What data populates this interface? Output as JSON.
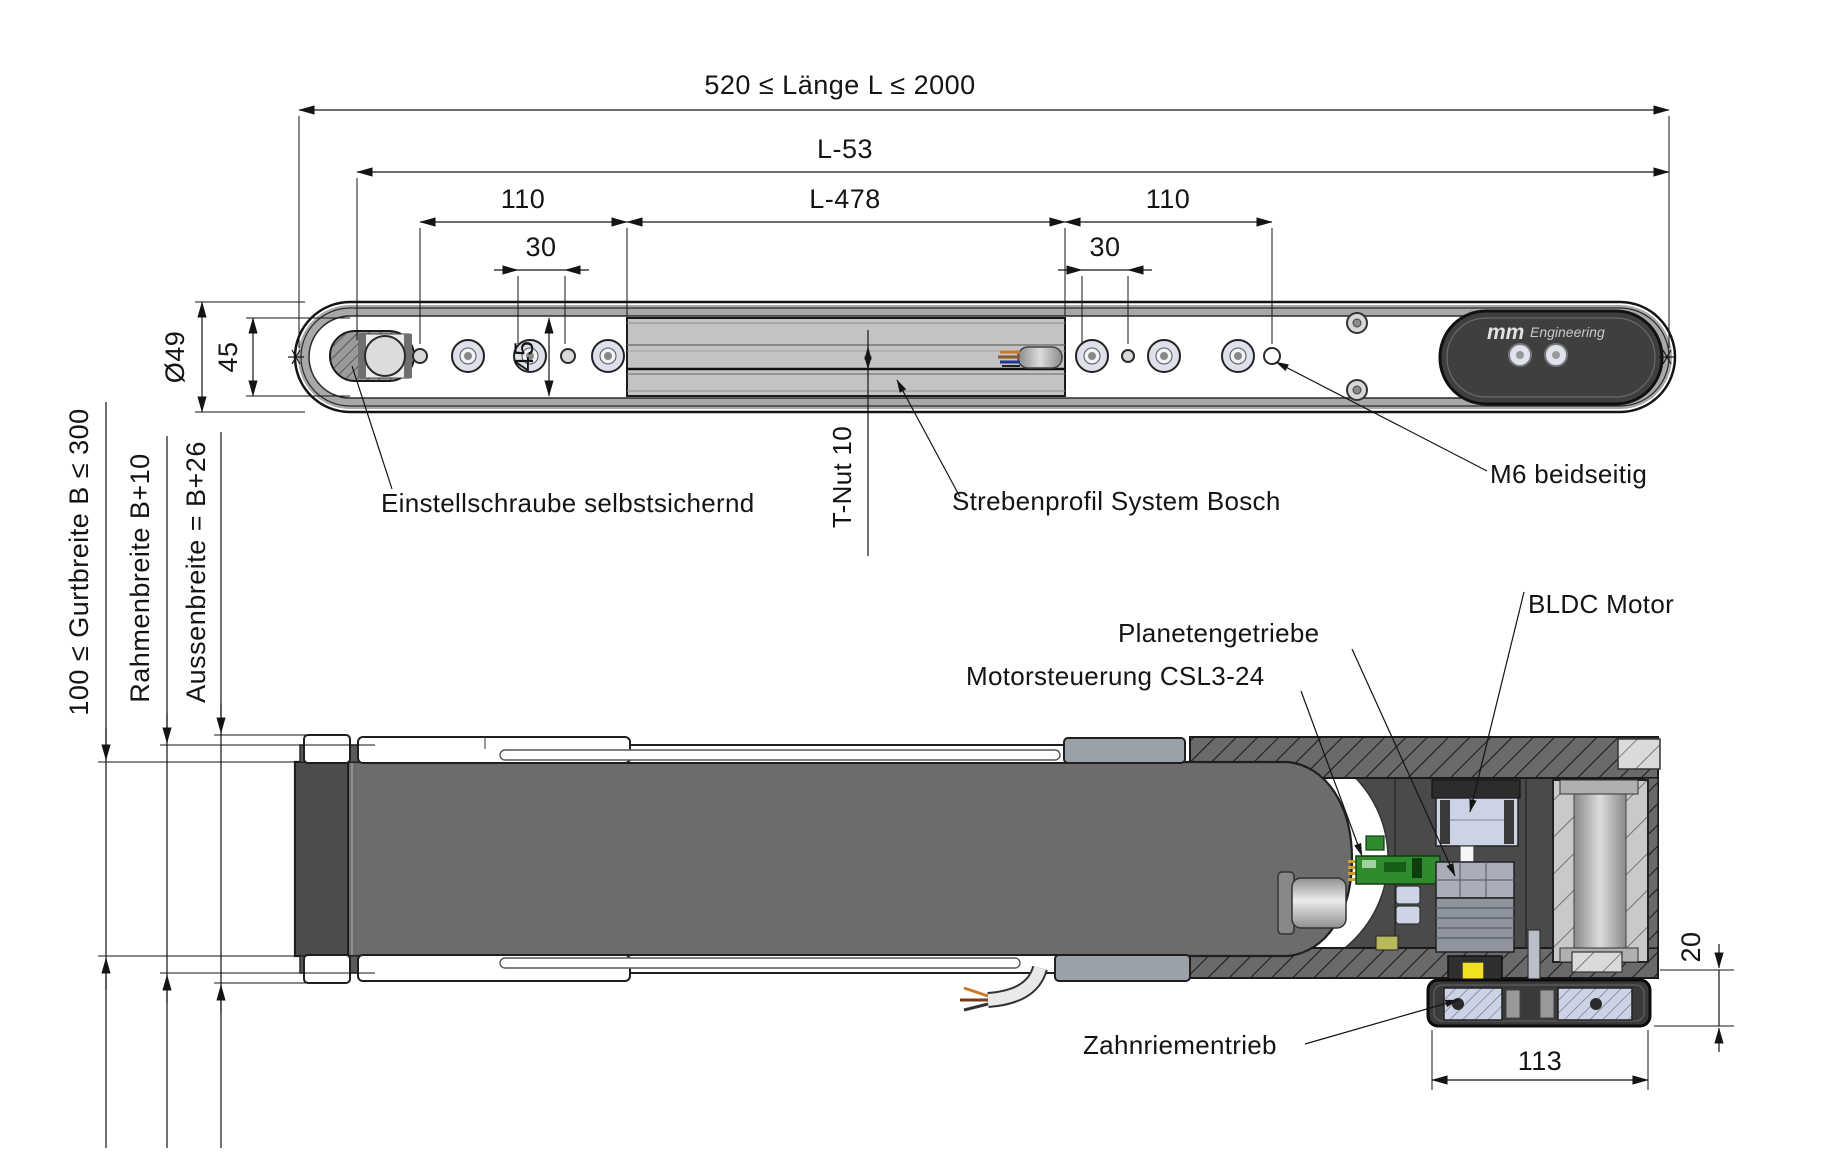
{
  "top_view": {
    "dims": {
      "overall_length": "520 ≤ Länge L ≤ 2000",
      "l53": "L-53",
      "left_110": "110",
      "l478": "L-478",
      "right_110": "110",
      "left_30": "30",
      "right_30": "30",
      "roller_diameter": "Ø49",
      "frame_height_45": "45",
      "mid_45": "45"
    },
    "labels": {
      "adjusting_screw": "Einstellschraube selbstsichernd",
      "t_slot": "T-Nut 10",
      "strut_profile": "Strebenprofil System Bosch",
      "m6_thread": "M6 beidseitig"
    },
    "logo": {
      "mm": "mm",
      "engineering": "Engineering"
    }
  },
  "bottom_view": {
    "dims": {
      "belt_width": "100 ≤ Gurtbreite B ≤ 300",
      "frame_width": "Rahmenbreite B+10",
      "outer_width": "Aussenbreite = B+26",
      "drive_length_113": "113",
      "drive_offset_20": "20"
    },
    "labels": {
      "motor_controller": "Motorsteuerung CSL3-24",
      "planetary_gear": "Planetengetriebe",
      "bldc_motor": "BLDC Motor",
      "timing_belt_drive": "Zahnriementrieb"
    }
  },
  "colors": {
    "line": "#141414",
    "belt_gray": "#6c6c6c",
    "profile_gray": "#c3c3c3",
    "end_cap_dark": "#3f3f3f",
    "pcb_green": "#2e8b2e",
    "motor_silver": "#ccd3e4",
    "tension_yellow": "#f0e020",
    "roller_light": "#c9c9c9"
  }
}
